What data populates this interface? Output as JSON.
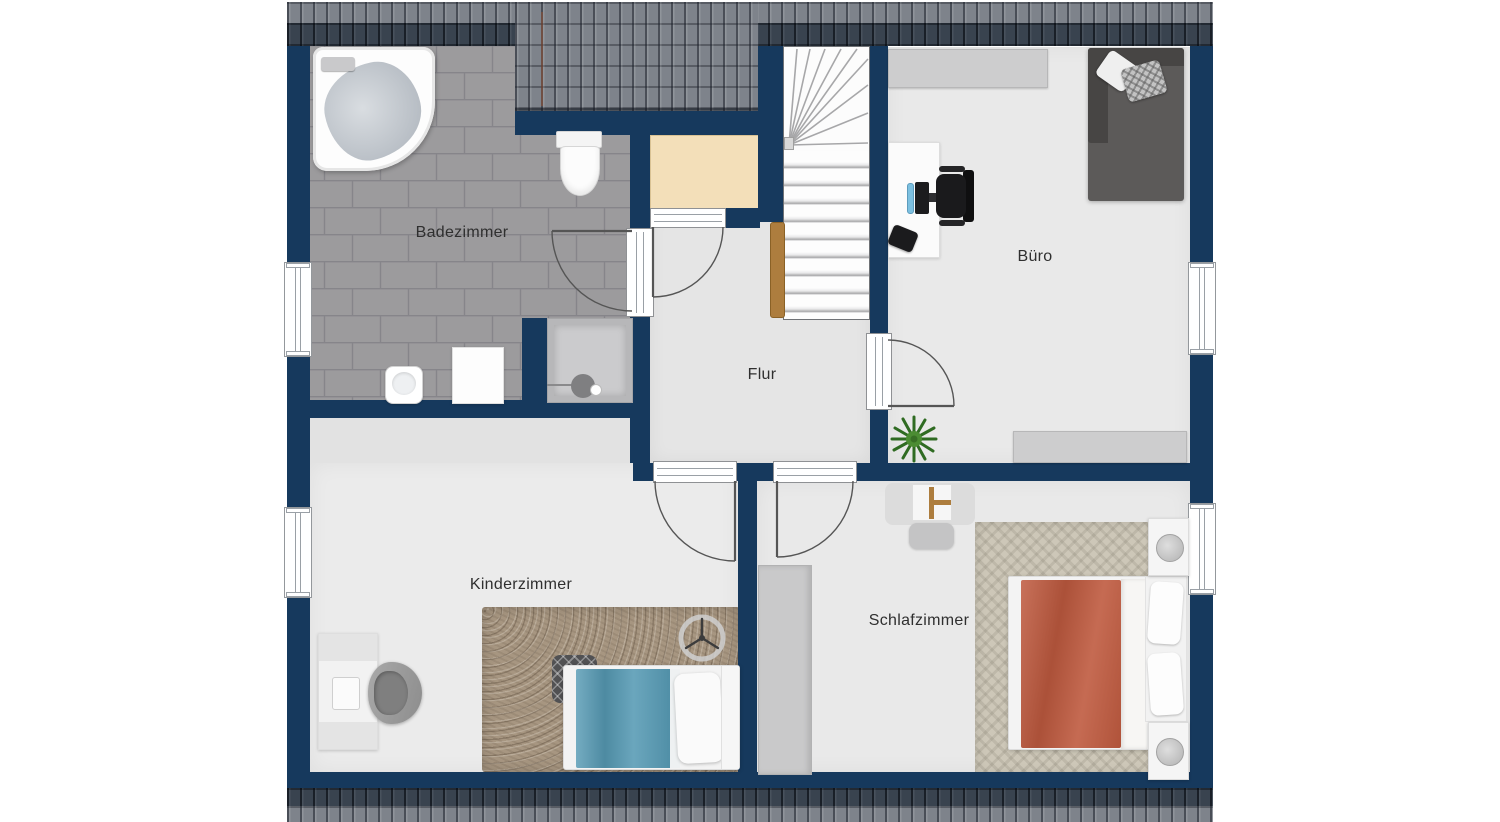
{
  "rooms": {
    "badezimmer": "Badezimmer",
    "flur": "Flur",
    "buero": "Büro",
    "kinderzimmer": "Kinderzimmer",
    "schlafzimmer": "Schlafzimmer"
  },
  "colors": {
    "wall": "#16395d",
    "roof_gray": "#7e838b",
    "roof_dark": "#39434f",
    "bath_tile": "#9c9b9d",
    "floor_light": "#e9e9e9",
    "closet_beige": "#f3dfb9",
    "wood": "#ad7d3e",
    "duvet_blue": "#569ab4",
    "duvet_red": "#bf5a3f",
    "rug_brown": "#a79681",
    "carpet_beige": "#cdc7b8",
    "plant_green": "#3f7d2c"
  }
}
